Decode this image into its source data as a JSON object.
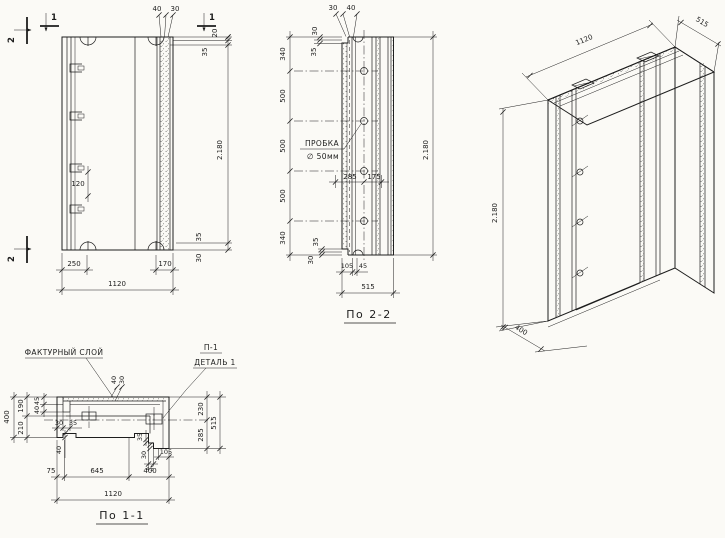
{
  "labels": {
    "texture_layer": "ФАКТУРНЫЙ СЛОЙ",
    "detail_ref": "П-1",
    "detail_name": "ДЕТАЛЬ 1",
    "plug_name": "ПРОБКА",
    "plug_size": "∅ 50мм",
    "section22_title": "По 2-2",
    "section11_title": "По 1-1"
  },
  "marks": {
    "s1": "1",
    "s2": "2"
  },
  "front": {
    "top_w1": "40",
    "top_w2": "30",
    "right_t1": "20",
    "right_t2": "35",
    "height": "2.180",
    "embed_spacing": "120",
    "bot_t1": "35",
    "bot_t2": "30",
    "bot_w1": "250",
    "bot_w2": "170",
    "total_width": "1120"
  },
  "sec22": {
    "top_w1": "30",
    "top_w2": "40",
    "left_t1": "30",
    "left_t2": "35",
    "chain": [
      "340",
      "500",
      "500",
      "500",
      "340"
    ],
    "mid_w1": "285",
    "mid_w2": "175",
    "bot_t1": "35",
    "bot_t2": "30",
    "bot_w1": "105",
    "bot_w2": "45",
    "total_width": "515",
    "height": "2.180"
  },
  "iso": {
    "width": "1120",
    "depth": "515",
    "height": "2.180",
    "base": "400"
  },
  "sec11": {
    "thickness": "400",
    "chain_top": "190",
    "chain_bot": "210",
    "notch_t1": "45",
    "notch_t2": "40",
    "notch_w1": "30",
    "notch_w2": "35",
    "tex_t1": "40",
    "tex_t2": "30",
    "mid_t1": "40",
    "mid_t2": "35",
    "mid_t3": "30",
    "mid_w1": "105",
    "mid_w2": "45",
    "right_c1": "230",
    "right_c2": "285",
    "right_total": "515",
    "bot_w1": "75",
    "bot_w2": "645",
    "bot_w3": "400",
    "total_width": "1120"
  }
}
